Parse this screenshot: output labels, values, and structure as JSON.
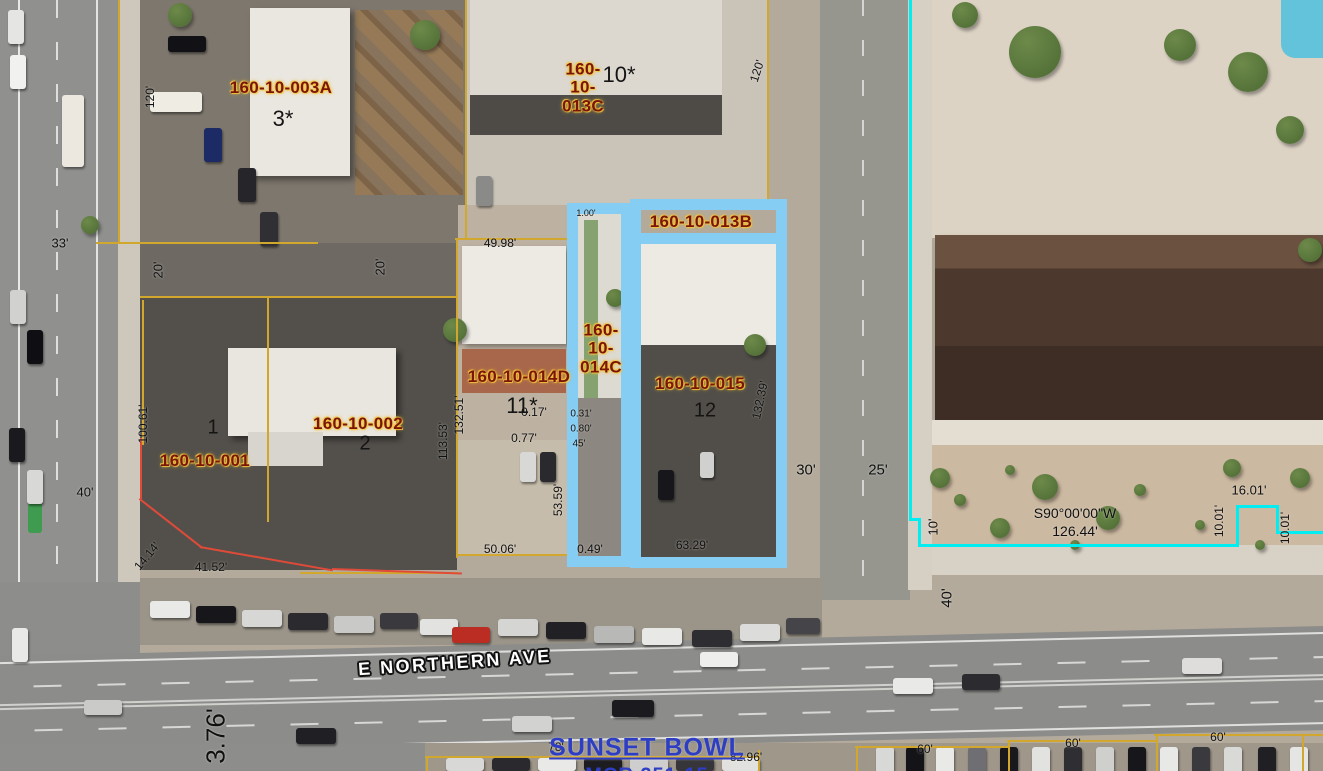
{
  "map": {
    "street_label": "E NORTHERN AVE",
    "place_label": {
      "text": "SUNSET BOWL",
      "subtext": "MCR 251-15"
    },
    "colors": {
      "parcel_line": "#d2a72e",
      "curb_line": "#e04a38",
      "boundary_line": "#00eef2",
      "highlight": "#86cdf3",
      "parcel_text": "#7a1508",
      "place_text": "#2e3ec4"
    },
    "parcel_labels": [
      {
        "text": "160-10-003A",
        "x": 281,
        "y": 88
      },
      {
        "text": "160-\n10-\n013C",
        "x": 583,
        "y": 88
      },
      {
        "text": "160-10-013B",
        "x": 701,
        "y": 222
      },
      {
        "text": "160-10-014D",
        "x": 519,
        "y": 377
      },
      {
        "text": "160-\n10-\n014C",
        "x": 601,
        "y": 349
      },
      {
        "text": "160-10-015",
        "x": 700,
        "y": 384
      },
      {
        "text": "160-10-002",
        "x": 358,
        "y": 424
      },
      {
        "text": "160-10-001",
        "x": 205,
        "y": 461
      }
    ],
    "lot_numbers": [
      {
        "text": "3*",
        "x": 283,
        "y": 119
      },
      {
        "text": "10*",
        "x": 619,
        "y": 75
      },
      {
        "text": "11*",
        "x": 522,
        "y": 406
      },
      {
        "text": "12",
        "x": 705,
        "y": 411,
        "size": 20
      },
      {
        "text": "2",
        "x": 365,
        "y": 444,
        "size": 20
      },
      {
        "text": "1",
        "x": 213,
        "y": 428,
        "size": 20
      }
    ],
    "dimensions": [
      {
        "text": "120'",
        "x": 150,
        "y": 97,
        "rot": -90
      },
      {
        "text": "120'",
        "x": 757,
        "y": 71,
        "rot": -72
      },
      {
        "text": "33'",
        "x": 60,
        "y": 243,
        "size": 13
      },
      {
        "text": "20'",
        "x": 158,
        "y": 270,
        "rot": -90,
        "size": 13
      },
      {
        "text": "20'",
        "x": 380,
        "y": 267,
        "rot": -90,
        "size": 13
      },
      {
        "text": "49.98'",
        "x": 500,
        "y": 243
      },
      {
        "text": "100.61'",
        "x": 143,
        "y": 424,
        "rot": -90
      },
      {
        "text": "40'",
        "x": 85,
        "y": 492,
        "size": 13
      },
      {
        "text": "14.14'",
        "x": 147,
        "y": 556,
        "rot": -50
      },
      {
        "text": "41.52'",
        "x": 211,
        "y": 567
      },
      {
        "text": "132.51'",
        "x": 459,
        "y": 415,
        "rot": -90
      },
      {
        "text": "113.53'",
        "x": 443,
        "y": 441,
        "rot": -90
      },
      {
        "text": "0.17'",
        "x": 534,
        "y": 412
      },
      {
        "text": "0.77'",
        "x": 524,
        "y": 438
      },
      {
        "text": "1.00'",
        "x": 586,
        "y": 213,
        "size": 9
      },
      {
        "text": "0.31'",
        "x": 581,
        "y": 414,
        "size": 10
      },
      {
        "text": "0.80'",
        "x": 581,
        "y": 429,
        "size": 10
      },
      {
        "text": "45'",
        "x": 579,
        "y": 444,
        "size": 10
      },
      {
        "text": "53.59'",
        "x": 558,
        "y": 500,
        "rot": -90
      },
      {
        "text": "50.06'",
        "x": 500,
        "y": 549
      },
      {
        "text": "0.49'",
        "x": 590,
        "y": 549
      },
      {
        "text": "63.29'",
        "x": 692,
        "y": 545
      },
      {
        "text": "132.39'",
        "x": 760,
        "y": 400,
        "rot": -78
      },
      {
        "text": "30'",
        "x": 806,
        "y": 470,
        "size": 15
      },
      {
        "text": "25'",
        "x": 878,
        "y": 470,
        "size": 15
      },
      {
        "text": "10'",
        "x": 933,
        "y": 527,
        "rot": -90,
        "size": 13
      },
      {
        "text": "40'",
        "x": 947,
        "y": 598,
        "rot": -90,
        "size": 15
      },
      {
        "text": "S90°00'00\"W",
        "x": 1075,
        "y": 513,
        "size": 14
      },
      {
        "text": "126.44'",
        "x": 1075,
        "y": 531,
        "size": 14
      },
      {
        "text": "16.01'",
        "x": 1249,
        "y": 490,
        "size": 13
      },
      {
        "text": "10.01'",
        "x": 1219,
        "y": 521,
        "rot": -90
      },
      {
        "text": "10.01'",
        "x": 1285,
        "y": 528,
        "rot": -90
      },
      {
        "text": "78'",
        "x": 556,
        "y": 747
      },
      {
        "text": "82.96'",
        "x": 746,
        "y": 757
      },
      {
        "text": "60'",
        "x": 925,
        "y": 749
      },
      {
        "text": "60'",
        "x": 1073,
        "y": 743
      },
      {
        "text": "60'",
        "x": 1218,
        "y": 737
      },
      {
        "text": "3.76'",
        "x": 216,
        "y": 736,
        "rot": -90,
        "size": 26
      }
    ],
    "boundaries": {
      "yellow": [
        {
          "x": 118,
          "y": 0,
          "w": 2,
          "h": 244
        },
        {
          "x": 96,
          "y": 242,
          "w": 222,
          "h": 2
        },
        {
          "x": 465,
          "y": 0,
          "w": 2,
          "h": 240
        },
        {
          "x": 767,
          "y": 0,
          "w": 2,
          "h": 200
        },
        {
          "x": 455,
          "y": 238,
          "w": 115,
          "h": 2
        },
        {
          "x": 456,
          "y": 238,
          "w": 2,
          "h": 320
        },
        {
          "x": 140,
          "y": 296,
          "w": 318,
          "h": 2
        },
        {
          "x": 267,
          "y": 296,
          "w": 2,
          "h": 226
        },
        {
          "x": 142,
          "y": 300,
          "w": 2,
          "h": 145
        },
        {
          "x": 457,
          "y": 554,
          "w": 112,
          "h": 2
        },
        {
          "x": 300,
          "y": 572,
          "w": 158,
          "h": 2
        },
        {
          "x": 425,
          "y": 756,
          "w": 335,
          "h": 2
        },
        {
          "x": 426,
          "y": 756,
          "w": 2,
          "h": 15
        },
        {
          "x": 758,
          "y": 750,
          "w": 2,
          "h": 21
        },
        {
          "x": 855,
          "y": 746,
          "w": 154,
          "h": 2
        },
        {
          "x": 856,
          "y": 746,
          "w": 2,
          "h": 25
        },
        {
          "x": 1007,
          "y": 740,
          "w": 149,
          "h": 2
        },
        {
          "x": 1008,
          "y": 740,
          "w": 2,
          "h": 31
        },
        {
          "x": 1154,
          "y": 734,
          "w": 169,
          "h": 2
        },
        {
          "x": 1156,
          "y": 734,
          "w": 2,
          "h": 37
        },
        {
          "x": 1302,
          "y": 734,
          "w": 2,
          "h": 37
        }
      ],
      "red": [
        {
          "x": 140,
          "y": 438,
          "w": 2,
          "h": 62
        },
        {
          "x": 140,
          "y": 498,
          "w": 80,
          "h": 2,
          "rot": 38
        },
        {
          "x": 200,
          "y": 546,
          "w": 135,
          "h": 2,
          "rot": 10
        },
        {
          "x": 332,
          "y": 568,
          "w": 130,
          "h": 2,
          "rot": 2
        }
      ],
      "cyan": [
        {
          "x": 909,
          "y": 0,
          "w": 3,
          "h": 520
        },
        {
          "x": 909,
          "y": 518,
          "w": 12,
          "h": 3
        },
        {
          "x": 918,
          "y": 518,
          "w": 3,
          "h": 29
        },
        {
          "x": 918,
          "y": 544,
          "w": 321,
          "h": 3
        },
        {
          "x": 1236,
          "y": 505,
          "w": 3,
          "h": 42
        },
        {
          "x": 1236,
          "y": 505,
          "w": 43,
          "h": 3
        },
        {
          "x": 1276,
          "y": 505,
          "w": 3,
          "h": 29
        },
        {
          "x": 1276,
          "y": 531,
          "w": 47,
          "h": 3
        }
      ]
    },
    "highlights": [
      {
        "apn": "160-10-014C",
        "x": 567,
        "y": 203,
        "w": 65,
        "h": 364,
        "style": "outline"
      },
      {
        "apn": "160-10-015",
        "x": 630,
        "y": 199,
        "w": 157,
        "h": 369,
        "style": "outline"
      },
      {
        "apn": "160-10-013B",
        "x": 638,
        "y": 233,
        "w": 141,
        "h": 11,
        "style": "bar"
      }
    ]
  },
  "scene": {
    "cars": [
      [
        150,
        601,
        40,
        17,
        "#e9e9e7"
      ],
      [
        196,
        606,
        40,
        17,
        "#17171b"
      ],
      [
        242,
        610,
        40,
        17,
        "#d7d7d5"
      ],
      [
        288,
        613,
        40,
        17,
        "#2b2b2f"
      ],
      [
        334,
        616,
        40,
        17,
        "#c9c9c7"
      ],
      [
        380,
        613,
        38,
        16,
        "#3a3a3e"
      ],
      [
        420,
        619,
        38,
        16,
        "#e2e2e0"
      ],
      [
        452,
        627,
        38,
        16,
        "#bb2d22"
      ],
      [
        498,
        619,
        40,
        17,
        "#d5d5d3"
      ],
      [
        546,
        622,
        40,
        17,
        "#212125"
      ],
      [
        594,
        626,
        40,
        17,
        "#b8b8b6"
      ],
      [
        642,
        628,
        40,
        17,
        "#e8e8e6"
      ],
      [
        692,
        630,
        40,
        17,
        "#2e2e32"
      ],
      [
        740,
        624,
        40,
        17,
        "#dcdcda"
      ],
      [
        786,
        618,
        34,
        16,
        "#454549"
      ],
      [
        612,
        700,
        42,
        17,
        "#1b1b1f"
      ],
      [
        512,
        716,
        40,
        16,
        "#d2d2d0"
      ],
      [
        893,
        678,
        40,
        16,
        "#e9e9e7"
      ],
      [
        962,
        674,
        38,
        16,
        "#2c2c30"
      ],
      [
        1182,
        658,
        40,
        16,
        "#dedddc"
      ],
      [
        296,
        728,
        40,
        16,
        "#202024"
      ],
      [
        84,
        700,
        38,
        15,
        "#cacac8"
      ],
      [
        700,
        652,
        38,
        15,
        "#eeeeec"
      ],
      [
        876,
        747,
        18,
        26,
        "#d8d8d6"
      ],
      [
        906,
        747,
        18,
        26,
        "#141418"
      ],
      [
        936,
        747,
        18,
        26,
        "#e9e9e7"
      ],
      [
        968,
        747,
        18,
        26,
        "#6f6f73"
      ],
      [
        1000,
        747,
        18,
        26,
        "#19191d"
      ],
      [
        1032,
        747,
        18,
        26,
        "#e2e2e0"
      ],
      [
        1064,
        747,
        18,
        26,
        "#2f2f33"
      ],
      [
        1096,
        747,
        18,
        26,
        "#cfcfcd"
      ],
      [
        1128,
        747,
        18,
        26,
        "#17171b"
      ],
      [
        1160,
        747,
        18,
        26,
        "#e8e8e6"
      ],
      [
        1192,
        747,
        18,
        26,
        "#3a3a3e"
      ],
      [
        1224,
        747,
        18,
        26,
        "#d9d9d7"
      ],
      [
        1258,
        747,
        18,
        26,
        "#202024"
      ],
      [
        1290,
        747,
        18,
        26,
        "#e5e5e3"
      ],
      [
        446,
        758,
        38,
        13,
        "#d8d8d6"
      ],
      [
        492,
        758,
        38,
        13,
        "#2a2a2e"
      ],
      [
        538,
        758,
        38,
        13,
        "#e9e9e7"
      ],
      [
        584,
        758,
        38,
        13,
        "#1d1d21"
      ],
      [
        630,
        758,
        38,
        13,
        "#cecece"
      ],
      [
        676,
        758,
        38,
        13,
        "#35353a"
      ],
      [
        722,
        758,
        38,
        13,
        "#e1e1df"
      ],
      [
        10,
        55,
        16,
        34,
        "#f1f1ef"
      ],
      [
        10,
        290,
        16,
        34,
        "#d1d1cf"
      ],
      [
        27,
        330,
        16,
        34,
        "#0f0f13"
      ],
      [
        9,
        428,
        16,
        34,
        "#1a1a1e"
      ],
      [
        27,
        470,
        16,
        34,
        "#d8d8d6"
      ],
      [
        12,
        628,
        16,
        34,
        "#e9e9e7"
      ],
      [
        8,
        10,
        16,
        34,
        "#e5e5e3"
      ],
      [
        62,
        95,
        22,
        72,
        "#ece8df"
      ],
      [
        204,
        128,
        18,
        34,
        "#1c2a66"
      ],
      [
        238,
        168,
        18,
        34,
        "#26262a"
      ],
      [
        260,
        212,
        18,
        34,
        "#303034"
      ],
      [
        150,
        92,
        52,
        20,
        "#efece4"
      ],
      [
        168,
        36,
        38,
        16,
        "#121216"
      ],
      [
        476,
        176,
        16,
        30,
        "#8a8a88"
      ],
      [
        520,
        452,
        16,
        30,
        "#d8d8d6"
      ],
      [
        540,
        452,
        16,
        30,
        "#2a2a2e"
      ],
      [
        658,
        470,
        16,
        30,
        "#17171b"
      ],
      [
        700,
        452,
        14,
        26,
        "#d0d0ce"
      ]
    ],
    "trees": [
      [
        1035,
        52,
        26
      ],
      [
        1248,
        72,
        20
      ],
      [
        1180,
        45,
        16
      ],
      [
        965,
        15,
        13
      ],
      [
        425,
        35,
        15
      ],
      [
        180,
        15,
        12
      ],
      [
        90,
        225,
        9
      ],
      [
        455,
        330,
        12
      ],
      [
        755,
        345,
        11
      ],
      [
        615,
        298,
        9
      ],
      [
        1045,
        487,
        13
      ],
      [
        1000,
        528,
        10
      ],
      [
        1108,
        518,
        12
      ],
      [
        1232,
        468,
        9
      ],
      [
        1300,
        478,
        10
      ],
      [
        940,
        478,
        10
      ],
      [
        1290,
        130,
        14
      ],
      [
        1310,
        250,
        12
      ],
      [
        960,
        500,
        6
      ],
      [
        1010,
        470,
        5
      ],
      [
        1140,
        490,
        6
      ],
      [
        1200,
        525,
        5
      ],
      [
        1260,
        545,
        5
      ],
      [
        1075,
        545,
        5
      ]
    ]
  }
}
